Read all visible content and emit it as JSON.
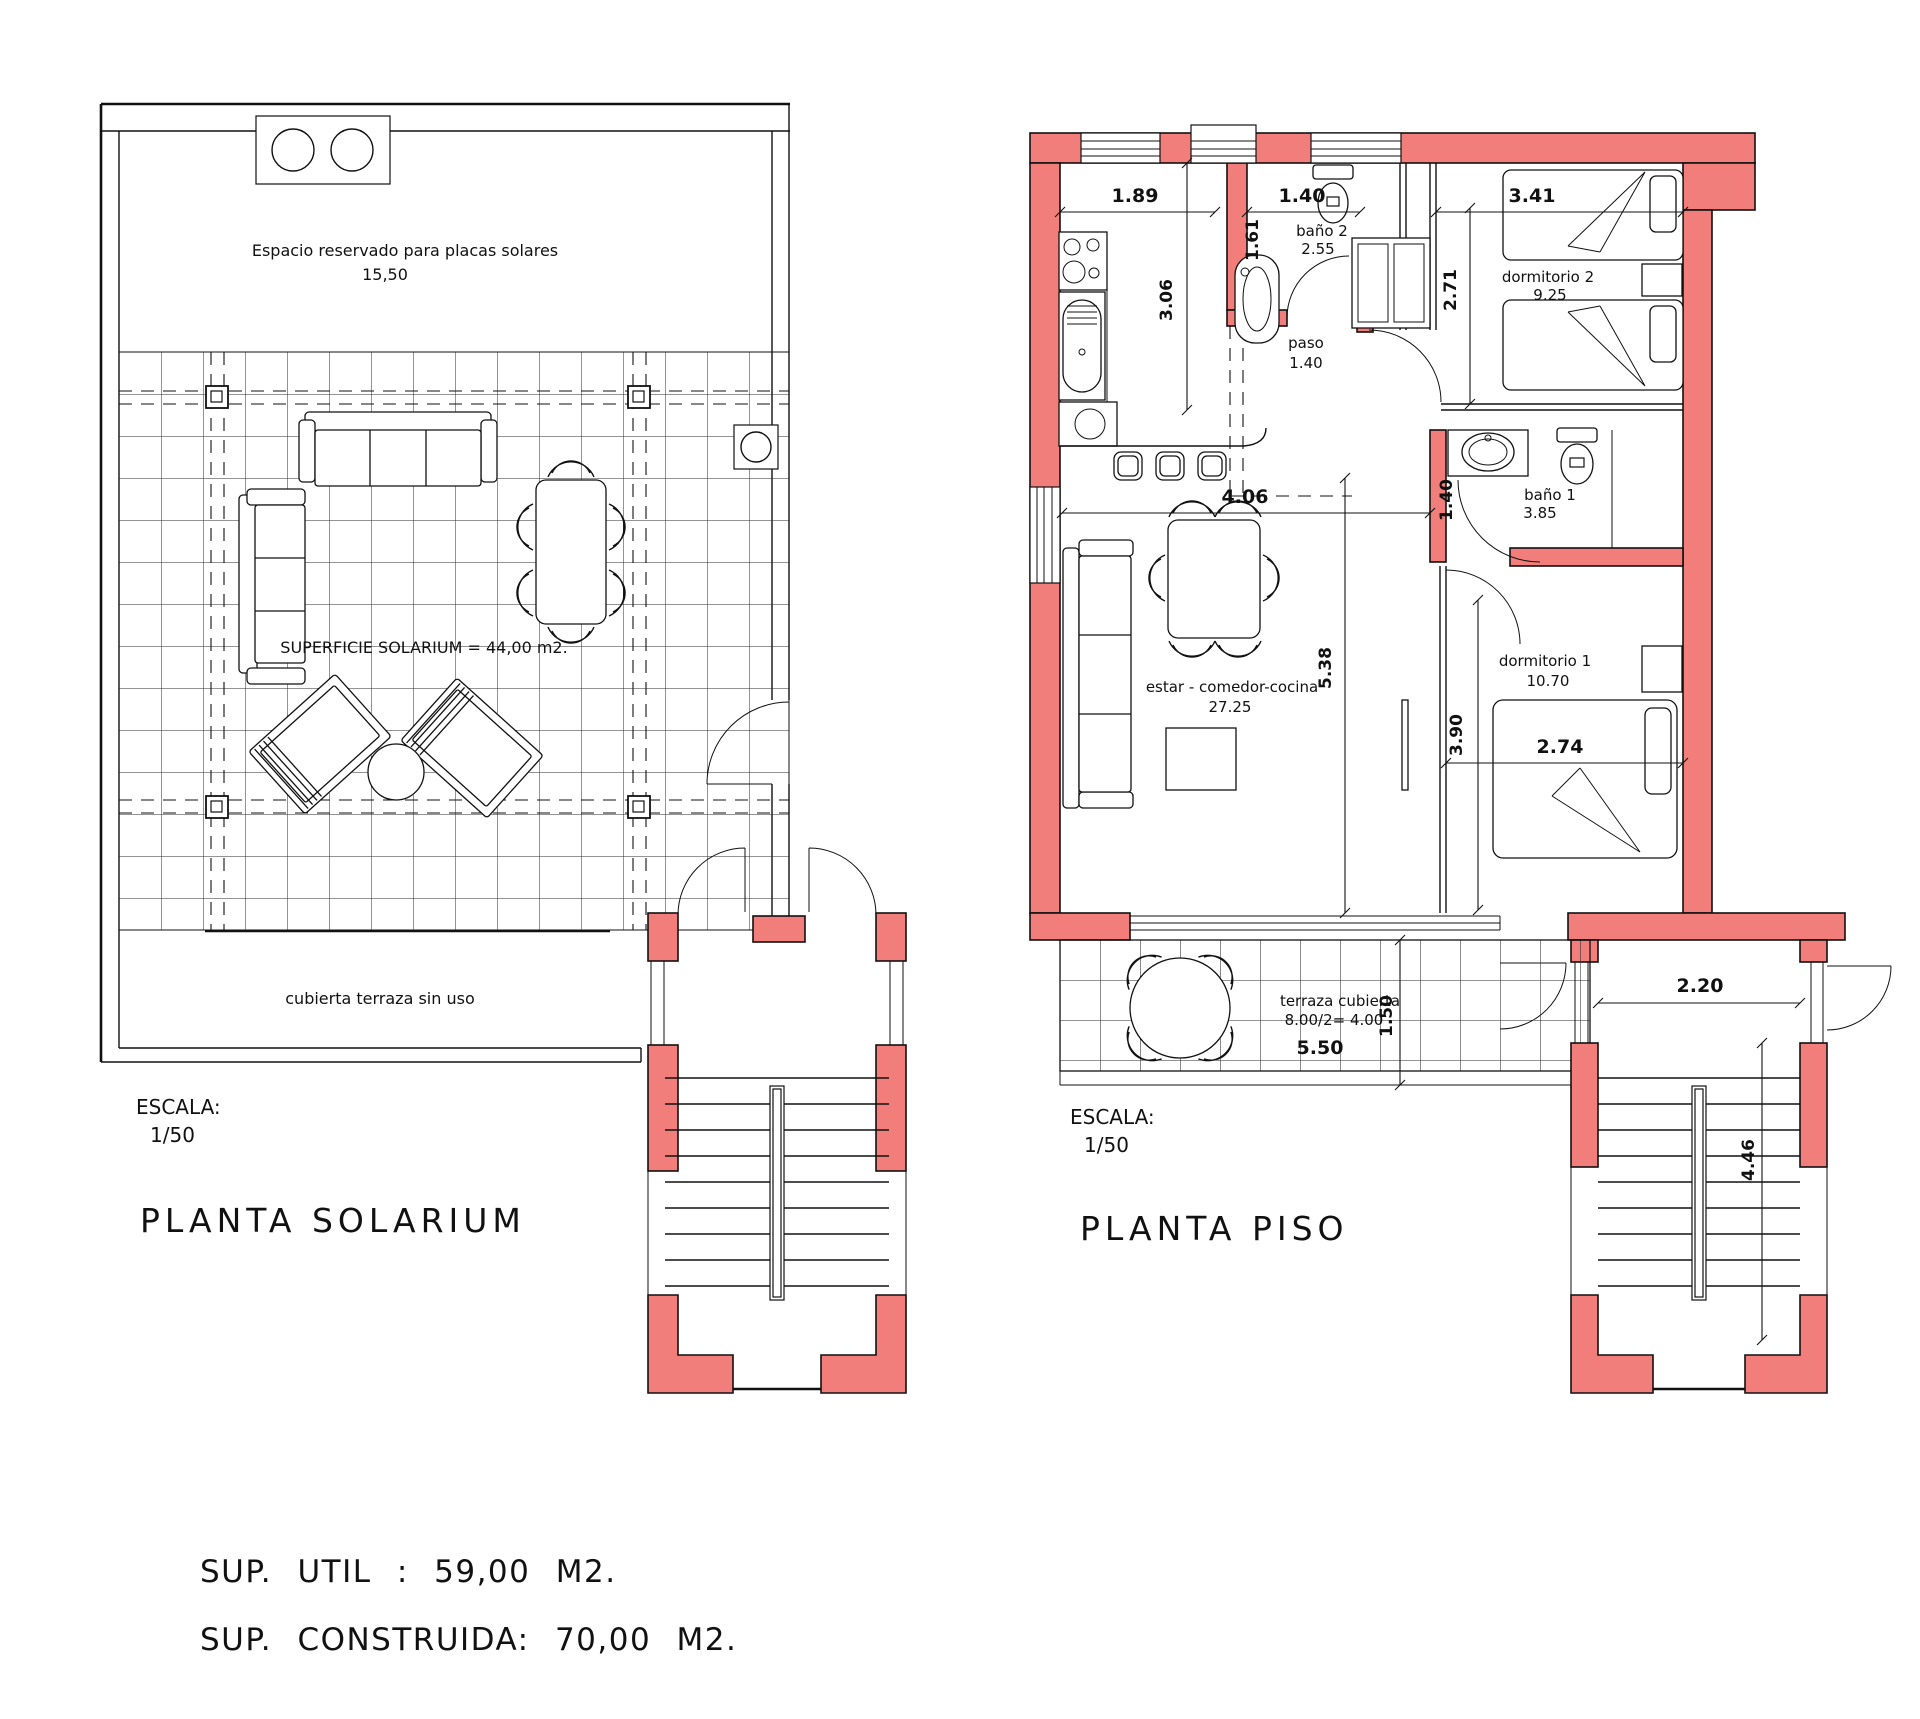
{
  "colors": {
    "wall_fill": "#F17E7B",
    "line": "#111111"
  },
  "solarium": {
    "title": "PLANTA SOLARIUM",
    "scale_label": "ESCALA:",
    "scale_value": "1/50",
    "roof_note": "Espacio reservado para placas solares",
    "roof_width_dim": "15,50",
    "deck_area_label": "SUPERFICIE SOLARIUM = 44,00 m2.",
    "terrace_note": "cubierta terraza sin uso"
  },
  "piso": {
    "title": "PLANTA PISO",
    "scale_label": "ESCALA:",
    "scale_value": "1/50",
    "rooms": {
      "bano2_name": "baño 2",
      "bano2_area": "2.55",
      "paso_name": "paso",
      "paso_area": "1.40",
      "dorm2_name": "dormitorio 2",
      "dorm2_area": "9.25",
      "bano1_name": "baño 1",
      "bano1_area": "3.85",
      "estar_name": "estar - comedor-cocina",
      "estar_area": "27.25",
      "dorm1_name": "dormitorio 1",
      "dorm1_area": "10.70",
      "terraza_name": "terraza cubierta",
      "terraza_calc": "8.00/2= 4.00",
      "terraza_width": "5.50"
    },
    "dims": {
      "kitchen_width": "1.89",
      "bano2_width": "1.40",
      "dorm2_width": "3.41",
      "kitchen_depth": "3.06",
      "bano2_depth": "1.61",
      "dorm2_depth": "2.71",
      "estar_width": "4.06",
      "bano1_entry": "1.40",
      "estar_depth": "5.38",
      "dorm1_depth": "3.90",
      "dorm1_width": "2.74",
      "terraza_depth": "1.50",
      "landing_width": "2.20",
      "stair_depth": "4.46"
    }
  },
  "summary": {
    "util": "SUP. UTIL : 59,00 M2.",
    "construida": "SUP. CONSTRUIDA: 70,00 M2."
  }
}
